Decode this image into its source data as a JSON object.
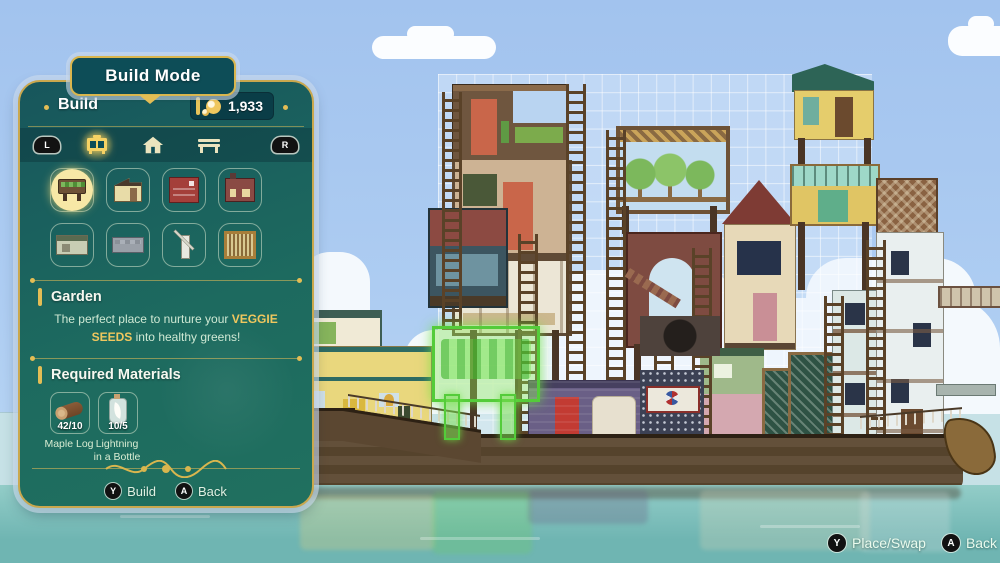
{
  "colors": {
    "panel_teal": "#17565c",
    "gold": "#e3bd55",
    "highlight_green": "#54cc3a",
    "sky": "#a7c8f0",
    "water": "#7fc1bd"
  },
  "panel": {
    "title": "Build Mode",
    "header": {
      "label": "Build",
      "currency_amount": "1,933",
      "currency_icon": "glim-icon"
    },
    "tab_bar": {
      "left_bumper": "L",
      "right_bumper": "R",
      "tabs": [
        {
          "id": "buildings",
          "icon": "cabinet-icon",
          "active": true
        },
        {
          "id": "improvements",
          "icon": "house-icon",
          "active": false
        },
        {
          "id": "furniture",
          "icon": "bench-icon",
          "active": false
        }
      ]
    },
    "build_grid": {
      "items": [
        {
          "id": "garden",
          "icon": "garden-icon",
          "selected": true
        },
        {
          "id": "house",
          "icon": "house-building-icon",
          "selected": false
        },
        {
          "id": "kitchen",
          "icon": "kitchen-icon",
          "selected": false
        },
        {
          "id": "foundry",
          "icon": "foundry-icon",
          "selected": false
        },
        {
          "id": "guest-cabin",
          "icon": "cabin-icon",
          "selected": false
        },
        {
          "id": "field",
          "icon": "field-icon",
          "selected": false
        },
        {
          "id": "windmill",
          "icon": "windmill-icon",
          "selected": false
        },
        {
          "id": "loom",
          "icon": "loom-icon",
          "selected": false
        }
      ]
    },
    "selection": {
      "name": "Garden",
      "description_prefix": "The perfect place to nurture your ",
      "description_highlight": "VEGGIE SEEDS",
      "description_suffix": " into healthy greens!"
    },
    "materials": {
      "heading": "Required Materials",
      "items": [
        {
          "name": "Maple Log",
          "count": "42/10",
          "icon": "log-icon"
        },
        {
          "name": "Lightning in a Bottle",
          "count": "10/5",
          "icon": "bottle-icon"
        }
      ]
    },
    "actions": [
      {
        "button": "Y",
        "label": "Build"
      },
      {
        "button": "A",
        "label": "Back"
      }
    ]
  },
  "scene": {
    "hints": [
      {
        "button": "Y",
        "label": "Place/Swap"
      },
      {
        "button": "A",
        "label": "Back"
      }
    ]
  }
}
